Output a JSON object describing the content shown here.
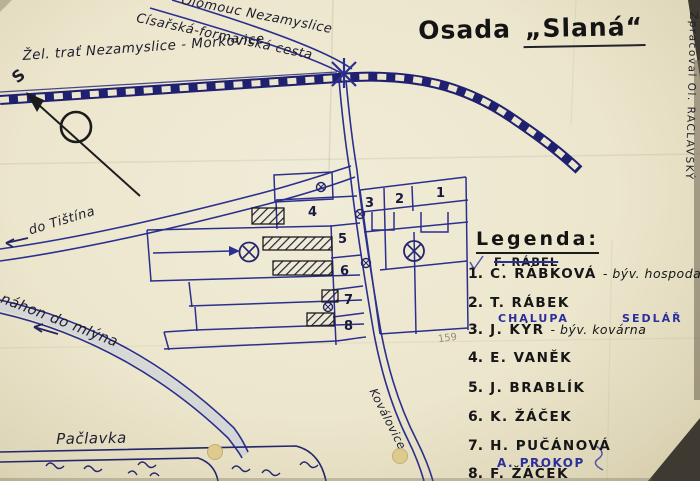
{
  "title": {
    "prefix": "Osada",
    "name": "„Slaná“"
  },
  "credit": "Zpracoval Ol. RACLAVSKÝ",
  "map_labels": {
    "railway": "Žel. trať Nezamyslice - Morkovice",
    "road_to_olomouc": "Olomouc  Nezamyslice",
    "imperial_road": "Císařská-formanská cesta",
    "road_to_tistin": "do Tištína",
    "mill_race": "náhon do mlýna",
    "stream": "Pačlavka",
    "road_to_kovalovice": "Koválovice",
    "north": "S"
  },
  "plot_numbers": [
    "1",
    "2",
    "3",
    "4",
    "5",
    "6",
    "7",
    "8"
  ],
  "legend": {
    "heading": "Legenda:",
    "entries": [
      {
        "num": "",
        "name": "F. RÁBEL",
        "note": ""
      },
      {
        "num": "1.",
        "name": "C. RÁBKOVÁ",
        "note": "- býv. hospoda"
      },
      {
        "num": "2.",
        "name": "T. RÁBEK",
        "note": ""
      },
      {
        "num": "",
        "name": "CHALUPA",
        "note": "SEDLÁŘ"
      },
      {
        "num": "3.",
        "name": "J. KÝR",
        "note": "- býv. kovárna"
      },
      {
        "num": "4.",
        "name": "E. VANĚK",
        "note": ""
      },
      {
        "num": "5.",
        "name": "J. BRABLÍK",
        "note": ""
      },
      {
        "num": "6.",
        "name": "K. ŽÁČEK",
        "note": ""
      },
      {
        "num": "7.",
        "name": "H. PUČÁNOVÁ",
        "note": ""
      },
      {
        "num": "",
        "name": "A. PROKOP",
        "note": ""
      },
      {
        "num": "8.",
        "name": "F. ŽÁČEK",
        "note": ""
      }
    ]
  },
  "pencil_note": "159",
  "symbols": {
    "well_large": "circled-x-well-icon",
    "well_small": "crossed-dot-well-icon",
    "railway": "checkered-band",
    "buildings": "hatched-rectangle",
    "north_arrow": "arrow-with-circle"
  },
  "colors": {
    "ink_blue": "#2b2f8e",
    "railway_navy": "#1f2170",
    "ink_black": "#1c1c1c",
    "paper": "#ece6cd",
    "pencil_gray": "#978e74"
  }
}
